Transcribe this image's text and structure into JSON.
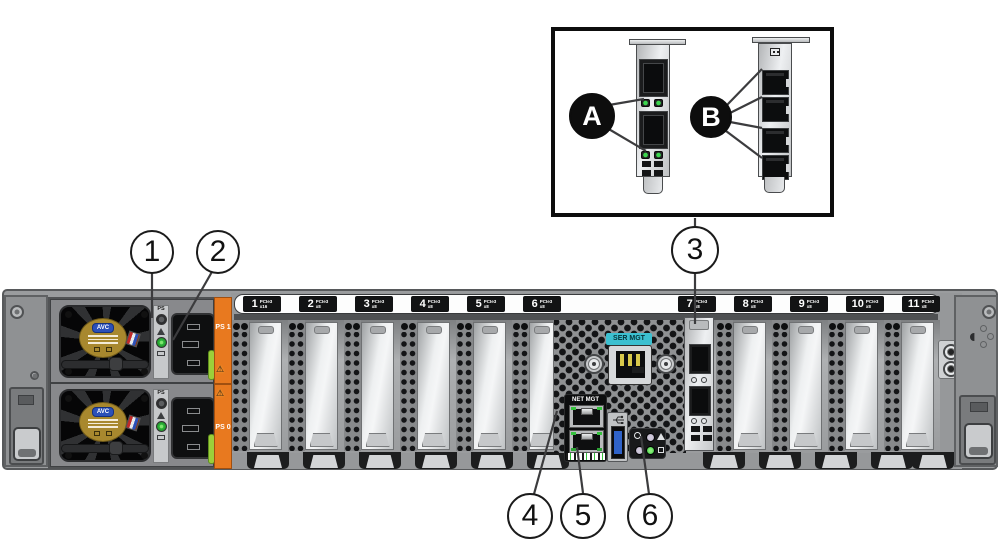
{
  "diagram": {
    "description": "Server rear panel callout diagram with PCIe card inset",
    "callouts": {
      "a": "A",
      "b": "B",
      "n1": "1",
      "n2": "2",
      "n3": "3",
      "n4": "4",
      "n5": "5",
      "n6": "6"
    },
    "chassis": {
      "pcie_slots": [
        {
          "num": "1",
          "gen": "PCIe3",
          "lanes": "x16"
        },
        {
          "num": "2",
          "gen": "PCIe3",
          "lanes": "x8"
        },
        {
          "num": "3",
          "gen": "PCIe3",
          "lanes": "x8"
        },
        {
          "num": "4",
          "gen": "PCIe3",
          "lanes": "x8"
        },
        {
          "num": "5",
          "gen": "PCIe3",
          "lanes": "x8"
        },
        {
          "num": "6",
          "gen": "PCIe3",
          "lanes": "x8"
        },
        {
          "num": "7",
          "gen": "PCIe3",
          "lanes": "x8"
        },
        {
          "num": "8",
          "gen": "PCIe3",
          "lanes": "x8"
        },
        {
          "num": "9",
          "gen": "PCIe3",
          "lanes": "x8"
        },
        {
          "num": "10",
          "gen": "PCIe3",
          "lanes": "x8"
        },
        {
          "num": "11",
          "gen": "PCIe3",
          "lanes": "x8"
        }
      ],
      "ser_mgt_label": "SER MGT",
      "net_mgt_label": "NET MGT",
      "psu": {
        "fan_brand": "AVC",
        "led_strip_label": "PS",
        "ps1_label": "PS 1",
        "ps0_label": "PS 0"
      }
    },
    "icons": {
      "warning_glyph": "⚠"
    },
    "colors": {
      "chassis_gray": "#9a9c9e",
      "orange_strip": "#e8791f",
      "ser_mgt_teal": "#3cc0d0",
      "green_led": "#35c23d",
      "usb_blue": "#2f62c8",
      "psu_latch_green": "#9ccf3a",
      "fan_label_gold": "#a8882e",
      "avc_logo_blue": "#2b50b8",
      "callout_line": "#3c3c3e"
    }
  }
}
